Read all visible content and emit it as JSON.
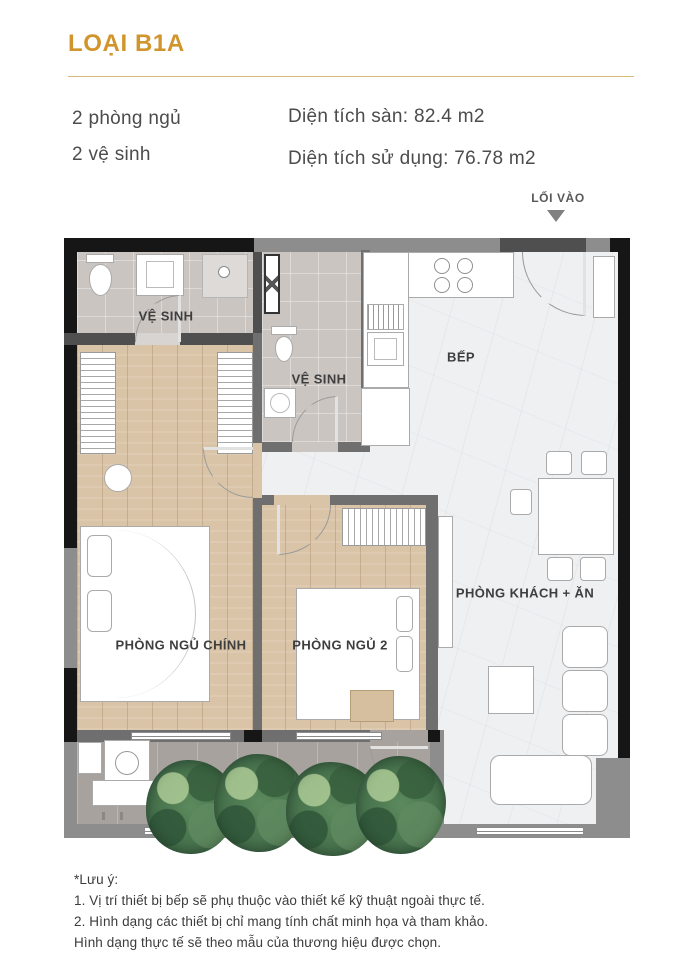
{
  "header": {
    "title": "LOẠI B1A"
  },
  "specs": {
    "bedrooms": "2 phòng ngủ",
    "bathrooms": "2 vệ sinh",
    "floor_area": "Diện tích sàn: 82.4 m2",
    "usable_area": "Diện tích sử dụng: 76.78 m2"
  },
  "entry": {
    "label": "LỐI VÀO"
  },
  "rooms": {
    "bathroom1": "VỆ SINH",
    "bathroom2": "VỆ SINH",
    "kitchen": "BẾP",
    "master_bedroom": "PHÒNG NGỦ CHÍNH",
    "bedroom2": "PHÒNG NGỦ 2",
    "living_dining": "PHÒNG KHÁCH + ĂN",
    "balcony": "LÔ GIA"
  },
  "notes": {
    "title": "*Lưu ý:",
    "lines": [
      "1. Vị trí thiết bị bếp sẽ phụ thuộc vào thiết kế kỹ thuật ngoài thực tế.",
      "2. Hình dạng các thiết bị chỉ mang tính chất minh họa và tham khảo.",
      "Hình dạng thực tế sẽ theo mẫu của thương hiệu được chọn."
    ]
  },
  "colors": {
    "accent": "#D1952E",
    "label": "#3E3E3E",
    "wall_dark": "#161616",
    "wall_gray": "#8D8D8D",
    "wood": "#D9C4A7",
    "tile": "#CBC5C2",
    "marble": "#EEF0F2",
    "balcony_floor": "#A8A29E"
  }
}
